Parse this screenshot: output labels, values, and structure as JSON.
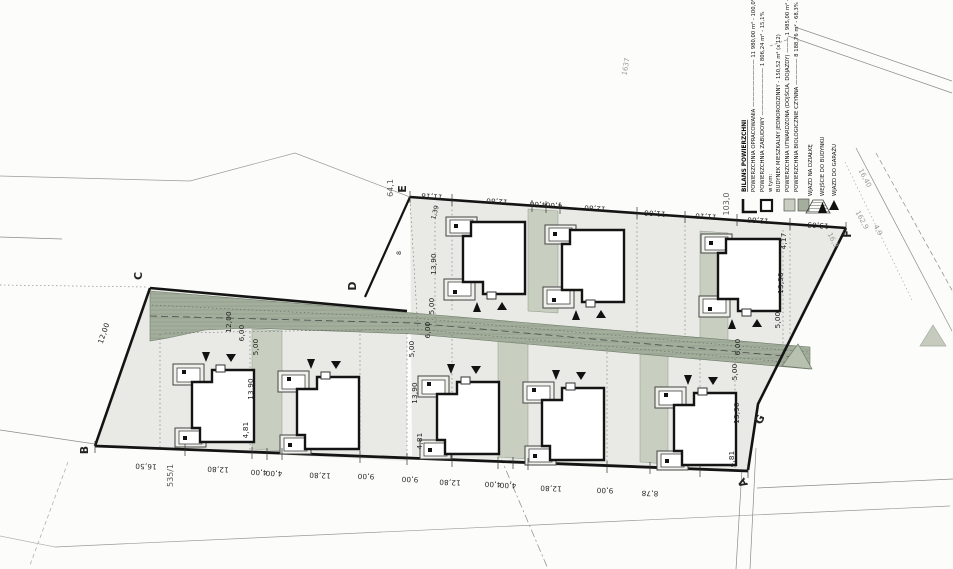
{
  "drawing_colors": {
    "ink": "#232323",
    "boundary": "#141414",
    "plot_fill": "#e9eae5",
    "road_fill": "#a3af9c",
    "road_hatch": "#7e8a78",
    "driveway_fill": "#c8cfc0",
    "porch_fill": "#eef0ea",
    "entry_symbol": "#b8c1af"
  },
  "corners": {
    "a": "A",
    "b": "B",
    "c": "C",
    "d": "D",
    "e": "E",
    "f": "F",
    "g": "G"
  },
  "parcels": [
    "535/1",
    "64,1",
    "103,0",
    "1637",
    "16,40",
    "16,3",
    "162,9",
    "4,9"
  ],
  "top_dims": [
    "11,18",
    "12,80",
    "4,00",
    "4,00",
    "12,80",
    "11,06",
    "11,10",
    "12,80",
    "13,03"
  ],
  "bottom_dims": [
    "16,50",
    "12,80",
    "4,00",
    "4,00",
    "12,80",
    "9,00",
    "9,00",
    "12,80",
    "4,00",
    "4,00",
    "12,80",
    "9,00",
    "8,78"
  ],
  "vdims": [
    "12,00",
    "12,00",
    "6,00",
    "5,00",
    "13,90",
    "4,81",
    "1,39",
    "13,90",
    "5,00",
    "6,00",
    "5,00",
    "13,90",
    "4,81",
    "4,17",
    "13,90",
    "5,00",
    "6,00",
    "5,00",
    "13,90",
    "4,81",
    "8"
  ],
  "legend": {
    "title": "BILANS POWIERZCHNI",
    "line_opracowania": "POWIERZCHNIA OPRACOWANIA ————————— 11 980,00 m² - 100,0%",
    "line_zabudowy": "POWIERZCHNIA ZABUDOWY ————————— 1 806,24 m² - 15,1%",
    "line_w_tym": "w tym:",
    "line_budynek": "BUDYNEK MIESZKALNY JEDNORODZINNY - 150,52 m² (x 12)",
    "line_utwardzona": "POWIERZCHNIA UTWARDZONA (DOJŚCIA, DOJAZDY) ——— 1 985,00 m² - 16,6%",
    "line_biologiczna": "POWIERZCHNIA BIOLOGICZNIE CZYNNA ————— 8 188,76 m² - 68,3%",
    "sym_wjazd_dzialka": "WJAZD NA DZIAŁKĘ",
    "sym_wejscie": "WEJŚCIE DO BUDYNKU",
    "sym_wjazd_garaz": "WJAZD DO GARAŻU"
  }
}
